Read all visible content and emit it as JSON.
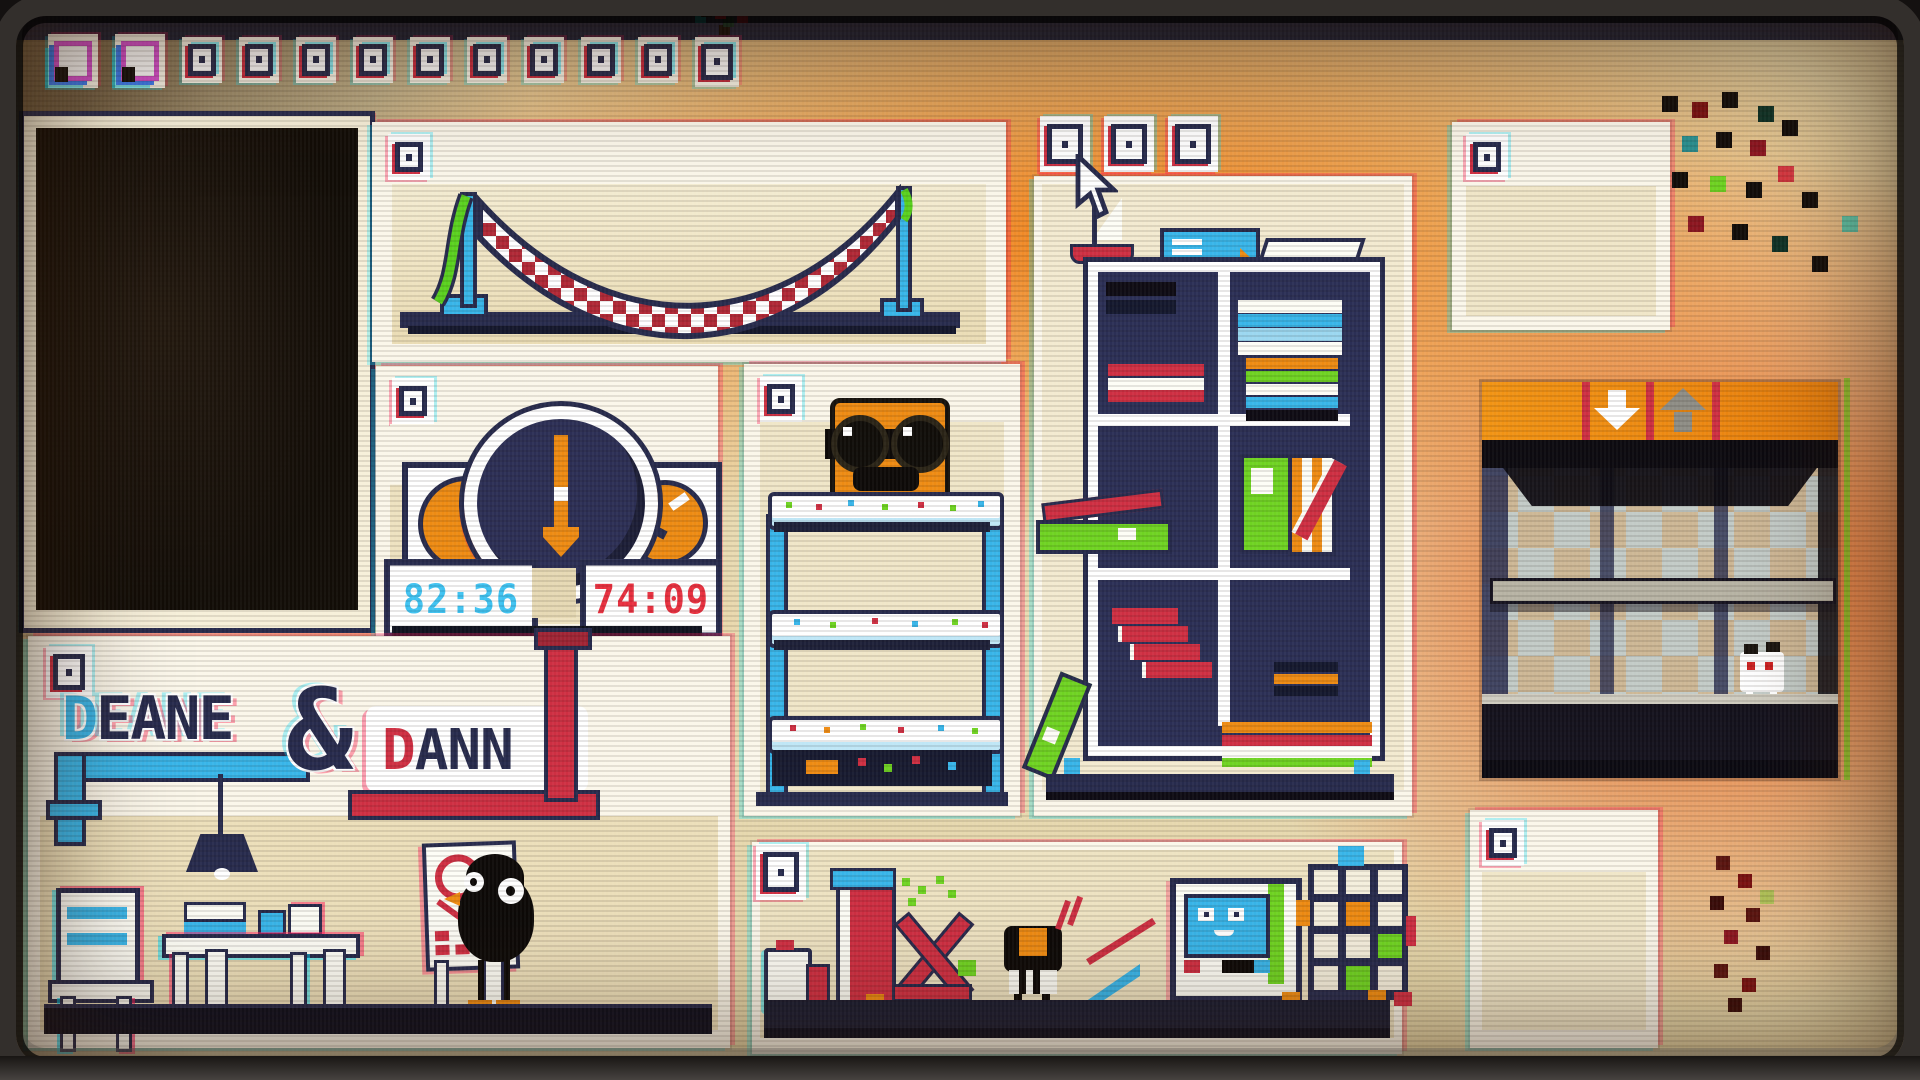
{
  "meta": {
    "scene": "pixel photo wall",
    "style": "CRT glitch pixel-art"
  },
  "palette": {
    "beige": "#e9dcb4",
    "photo": "#f0e6c8",
    "white": "#fbf7ea",
    "navy": "#272b4d",
    "navy-deep": "#171a30",
    "black": "#0e0b08",
    "red": "#ce2f42",
    "red-deep": "#a02434",
    "blue": "#38b5e9",
    "green": "#6fd322",
    "orange": "#ee8b13",
    "lcd-blue": "#3fc3f2",
    "lcd-red": "#e8303f",
    "check-a": "#cdb795",
    "check-b": "#c3cbc7",
    "gray": "#b7b3a4"
  },
  "top_stamps": [
    "large",
    "large",
    "small",
    "small",
    "small",
    "small",
    "small",
    "small",
    "small",
    "small",
    "small",
    "glitch"
  ],
  "logo": {
    "d1": "D",
    "rest1": "EANE",
    "amp": "&",
    "d2": "D",
    "rest2": "ANN"
  },
  "clock_panel": {
    "timer_left": "82:36",
    "timer_right": "74:09"
  },
  "panels": [
    {
      "id": "dark-window"
    },
    {
      "id": "hammock"
    },
    {
      "id": "clock"
    },
    {
      "id": "bunk-beds"
    },
    {
      "id": "bookshelf"
    },
    {
      "id": "frame-top-right"
    },
    {
      "id": "elevator"
    },
    {
      "id": "workshop"
    },
    {
      "id": "frame-bottom-right"
    },
    {
      "id": "logo-desk"
    }
  ]
}
